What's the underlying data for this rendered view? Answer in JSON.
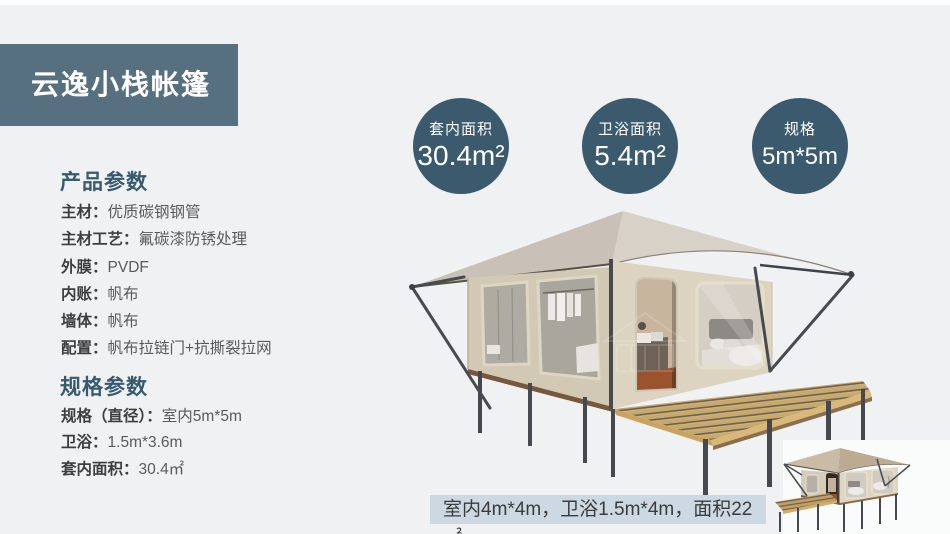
{
  "title": {
    "text": "云逸小栈帐篷"
  },
  "product_params": {
    "heading": "产品参数",
    "items": [
      {
        "label": "主材：",
        "value": "优质碳钢钢管"
      },
      {
        "label": "主材工艺：",
        "value": "氟碳漆防锈处理"
      },
      {
        "label": "外膜：",
        "value": "PVDF"
      },
      {
        "label": "内账：",
        "value": "帆布"
      },
      {
        "label": "墙体：",
        "value": "帆布"
      },
      {
        "label": "配置：",
        "value": "帆布拉链门+抗撕裂拉网"
      }
    ]
  },
  "spec_params": {
    "heading": "规格参数",
    "items": [
      {
        "label": "规格（直径）：",
        "value": "室内5m*5m"
      },
      {
        "label": "卫浴：",
        "value": "1.5m*3.6m"
      },
      {
        "label": "套内面积：",
        "value": "30.4㎡"
      }
    ]
  },
  "stat_circles": [
    {
      "label": "套内面积",
      "value": "30.4m²"
    },
    {
      "label": "卫浴面积",
      "value": "5.4m²"
    },
    {
      "label": "规格",
      "value": "5m*5m"
    }
  ],
  "caption": {
    "text": "室内4m*4m，卫浴1.5m*4m，面积22㎡"
  },
  "colors": {
    "page_bg": "#f0f1f2",
    "banner_bg": "#57707f",
    "heading_blue": "#375a6e",
    "circle_bg": "#3c5a6e",
    "caption_bg": "#ccd8e2",
    "roof_beige": "#d8d1c8",
    "wall_beige": "#dcd3c1",
    "deck_wood": "#c8a96c",
    "metal_dark": "#474a4f"
  }
}
